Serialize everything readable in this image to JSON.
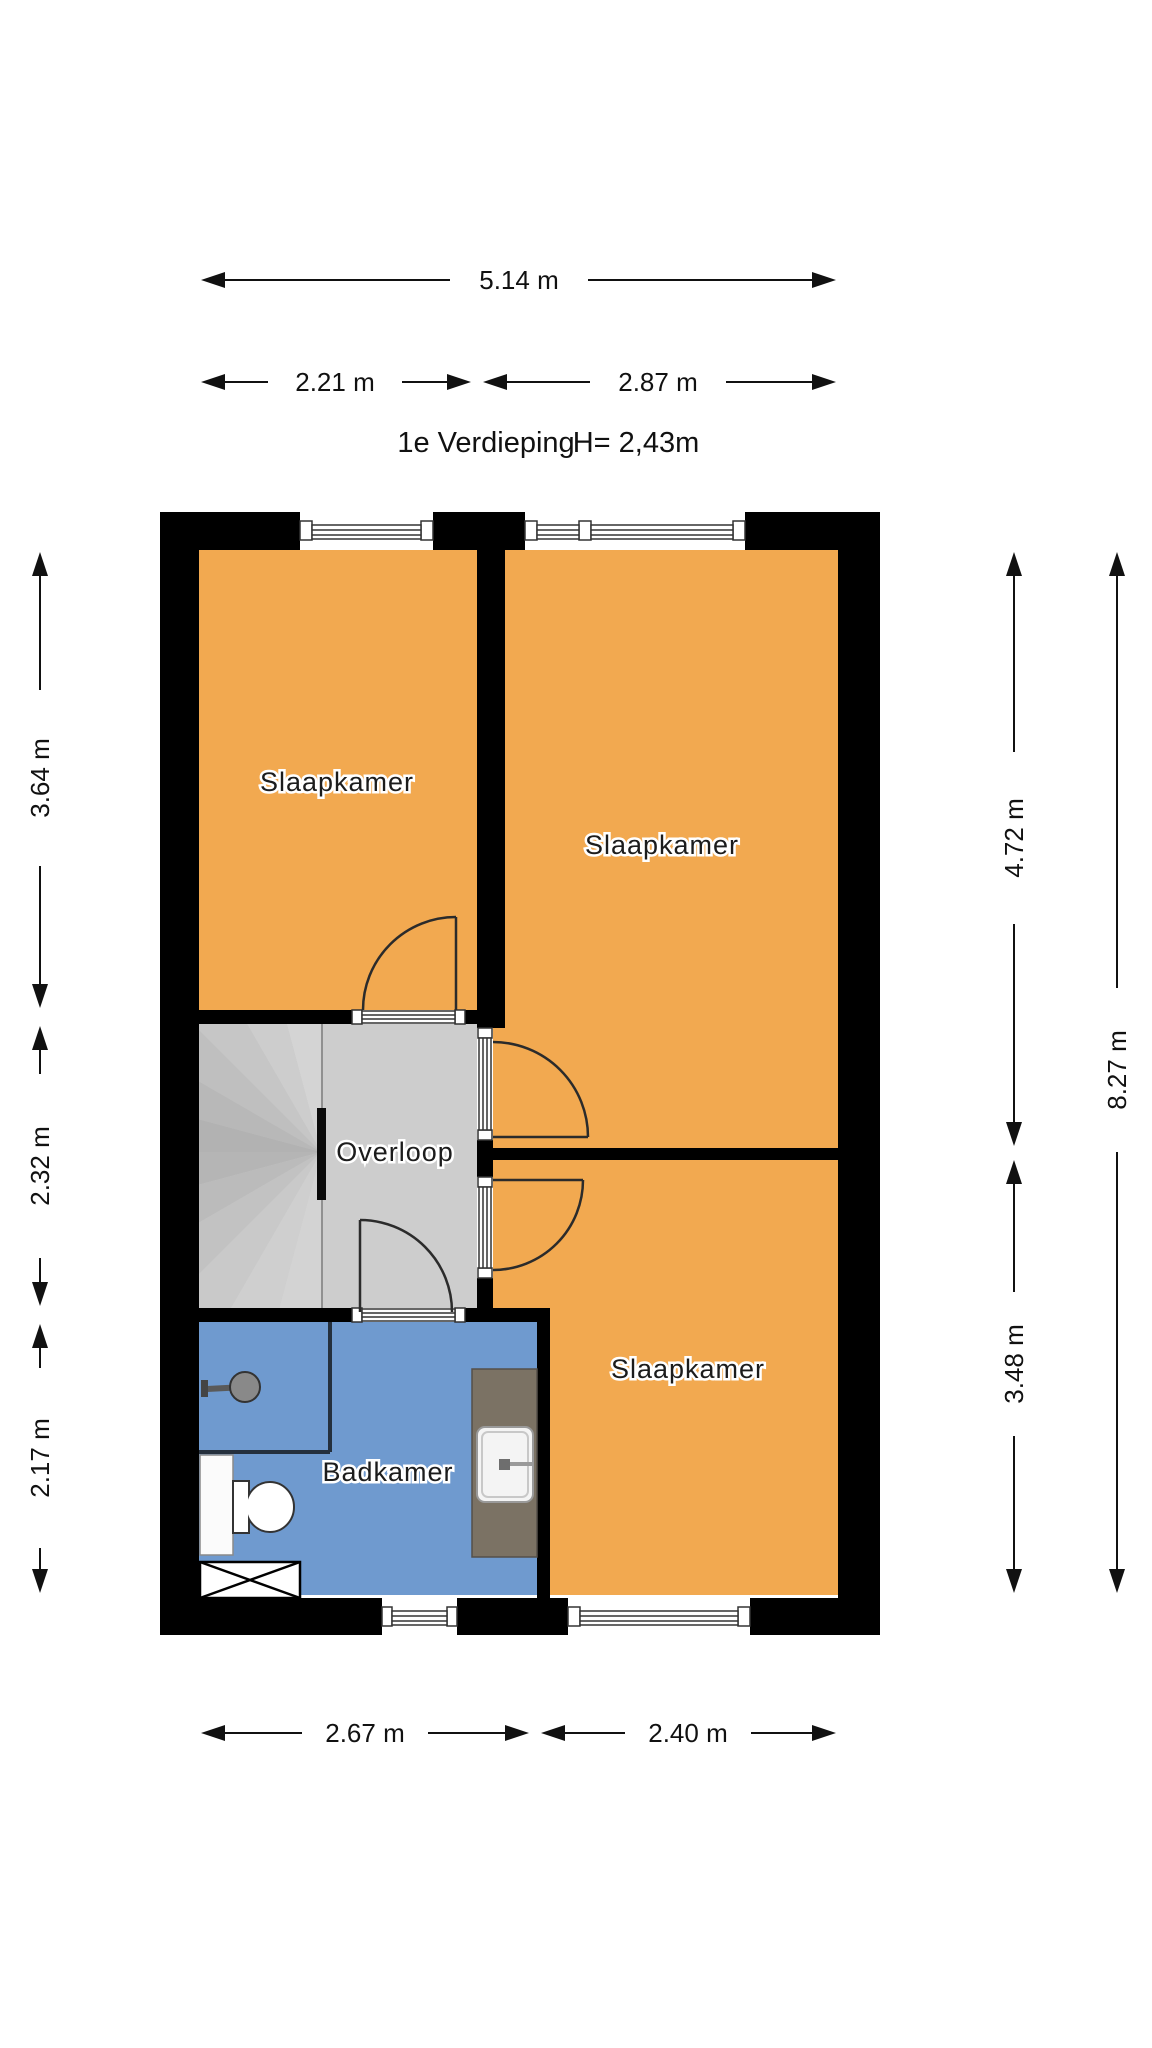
{
  "floorplan": {
    "title": "1e Verdieping",
    "ceiling_height": "H= 2,43m",
    "rooms": {
      "slaapkamer1": {
        "label": "Slaapkamer"
      },
      "slaapkamer2": {
        "label": "Slaapkamer"
      },
      "slaapkamer3": {
        "label": "Slaapkamer"
      },
      "overloop": {
        "label": "Overloop"
      },
      "badkamer": {
        "label": "Badkamer"
      }
    },
    "dimensions": {
      "top_total": "5.14 m",
      "top_left": "2.21 m",
      "top_right": "2.87 m",
      "left_upper": "3.64 m",
      "left_middle": "2.32 m",
      "left_lower": "2.17 m",
      "right_upper": "4.72 m",
      "right_lower": "3.48 m",
      "right_total": "8.27 m",
      "bottom_left": "2.67 m",
      "bottom_right": "2.40 m"
    },
    "colors": {
      "wall": "#000000",
      "bedroom_fill": "#F2A950",
      "bathroom_fill": "#6F9ACF",
      "landing_fill": "#CDCDCD",
      "stairs_fill": "#C6C6C6",
      "counter_fill": "#7B7264"
    }
  }
}
